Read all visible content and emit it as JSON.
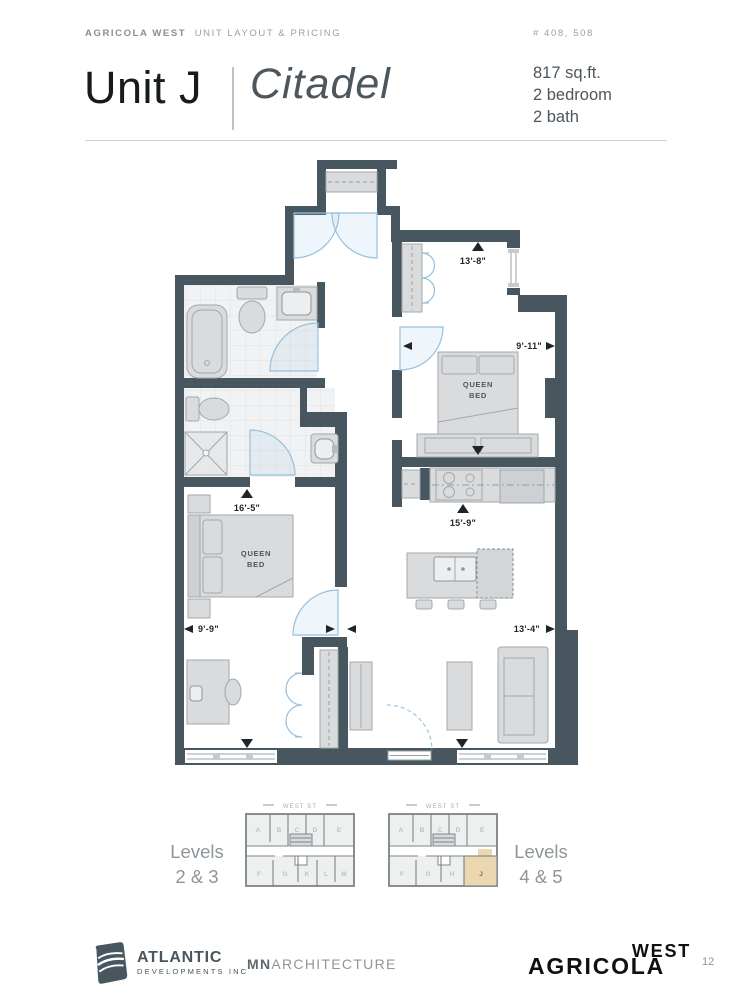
{
  "header": {
    "brand": "AGRICOLA WEST",
    "section": "UNIT LAYOUT & PRICING",
    "unit_numbers": "# 408, 508"
  },
  "title": {
    "unit": "Unit J",
    "name": "Citadel",
    "area": "817 sq.ft.",
    "bedrooms": "2 bedroom",
    "baths": "2 bath"
  },
  "floorplan": {
    "dimensions": {
      "bedroom2_height": "13'-8\"",
      "bedroom2_width": "9'-11\"",
      "kitchen_height": "15'-9\"",
      "living_width": "13'-4\"",
      "bedroom1_height": "16'-5\"",
      "bedroom1_width": "9'-9\""
    },
    "labels": {
      "bed2_line1": "QUEEN",
      "bed2_line2": "BED",
      "bed1_line1": "QUEEN",
      "bed1_line2": "BED"
    },
    "wall_color": "#47565f",
    "door_color": "#95c0de"
  },
  "keyplans": {
    "street": "WEST ST",
    "left": {
      "levels_line1": "Levels",
      "levels_line2": "2 & 3",
      "top_units": [
        "A",
        "B",
        "C",
        "D",
        "E"
      ],
      "bottom_units": [
        "F",
        "G",
        "K",
        "L",
        "M"
      ]
    },
    "right": {
      "levels_line1": "Levels",
      "levels_line2": "4 & 5",
      "top_units": [
        "A",
        "B",
        "C",
        "D",
        "E"
      ],
      "bottom_units": [
        "F",
        "G",
        "H",
        "J"
      ],
      "highlighted_unit": "J",
      "highlight_color": "#ecd8b0"
    }
  },
  "footer": {
    "developer_name": "ATLANTIC",
    "developer_sub": "DEVELOPMENTS INC",
    "architect_bold": "MN",
    "architect_rest": "ARCHITECTURE",
    "brand_main": "AGRICOLA",
    "brand_sub": "WEST",
    "page_number": "12"
  }
}
